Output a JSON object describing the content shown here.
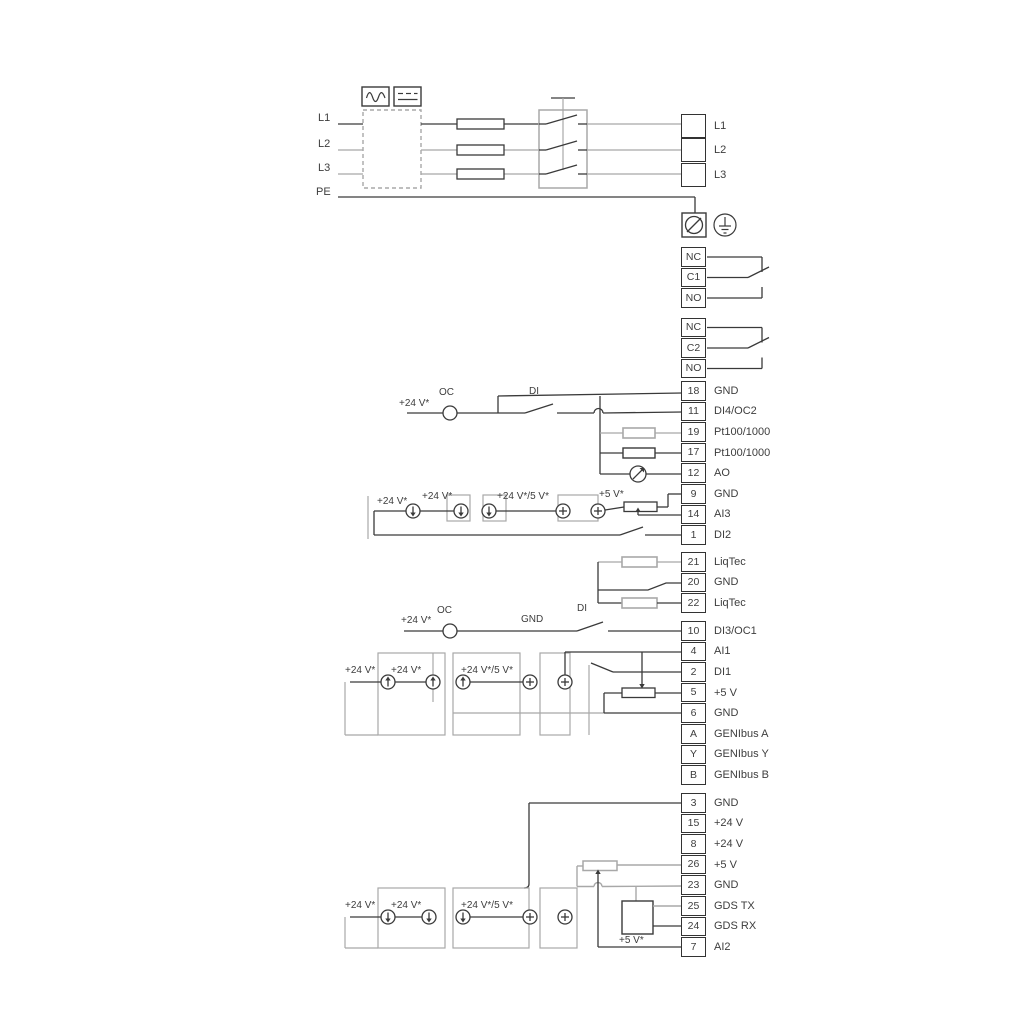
{
  "colors": {
    "wire": "#3a3a3a",
    "wire_gray": "#a8a8a8",
    "text": "#3d3d3d",
    "terminal_border": "#333333",
    "background": "#ffffff"
  },
  "power": {
    "left_labels": [
      "L1",
      "L2",
      "L3",
      "PE"
    ],
    "right_terminals": [
      "L1",
      "L2",
      "L3"
    ]
  },
  "relays": [
    {
      "rows": [
        "NC",
        "C1",
        "NO"
      ]
    },
    {
      "rows": [
        "NC",
        "C2",
        "NO"
      ]
    }
  ],
  "io_terminals": [
    {
      "rows": [
        {
          "n": "18",
          "t": "GND"
        },
        {
          "n": "11",
          "t": "DI4/OC2"
        },
        {
          "n": "19",
          "t": "Pt100/1000"
        },
        {
          "n": "17",
          "t": "Pt100/1000"
        },
        {
          "n": "12",
          "t": "AO"
        },
        {
          "n": "9",
          "t": "GND"
        },
        {
          "n": "14",
          "t": "AI3"
        },
        {
          "n": "1",
          "t": "DI2"
        }
      ]
    },
    {
      "rows": [
        {
          "n": "21",
          "t": "LiqTec"
        },
        {
          "n": "20",
          "t": "GND"
        },
        {
          "n": "22",
          "t": "LiqTec"
        }
      ]
    },
    {
      "rows": [
        {
          "n": "10",
          "t": "DI3/OC1"
        },
        {
          "n": "4",
          "t": "AI1"
        },
        {
          "n": "2",
          "t": "DI1"
        },
        {
          "n": "5",
          "t": "+5 V"
        },
        {
          "n": "6",
          "t": "GND"
        },
        {
          "n": "A",
          "t": "GENIbus A"
        },
        {
          "n": "Y",
          "t": "GENIbus Y"
        },
        {
          "n": "B",
          "t": "GENIbus B"
        }
      ]
    },
    {
      "rows": [
        {
          "n": "3",
          "t": "GND"
        },
        {
          "n": "15",
          "t": "+24 V"
        },
        {
          "n": "8",
          "t": "+24 V"
        },
        {
          "n": "26",
          "t": "+5 V"
        },
        {
          "n": "23",
          "t": "GND"
        },
        {
          "n": "25",
          "t": "GDS TX"
        },
        {
          "n": "24",
          "t": "GDS RX"
        },
        {
          "n": "7",
          "t": "AI2"
        }
      ]
    }
  ],
  "labels": [
    {
      "text": "+24 V*"
    },
    {
      "text": "OC"
    },
    {
      "text": "DI"
    },
    {
      "text": "+24 V*"
    },
    {
      "text": "+24 V*"
    },
    {
      "text": "+24 V*/5 V*"
    },
    {
      "text": "+5 V*"
    },
    {
      "text": "+24 V*"
    },
    {
      "text": "OC"
    },
    {
      "text": "GND"
    },
    {
      "text": "DI"
    },
    {
      "text": "+24 V*"
    },
    {
      "text": "+24 V*"
    },
    {
      "text": "+24 V*/5 V*"
    },
    {
      "text": "+24 V*"
    },
    {
      "text": "+24 V*"
    },
    {
      "text": "+24 V*/5 V*"
    },
    {
      "text": "+5 V*"
    }
  ]
}
